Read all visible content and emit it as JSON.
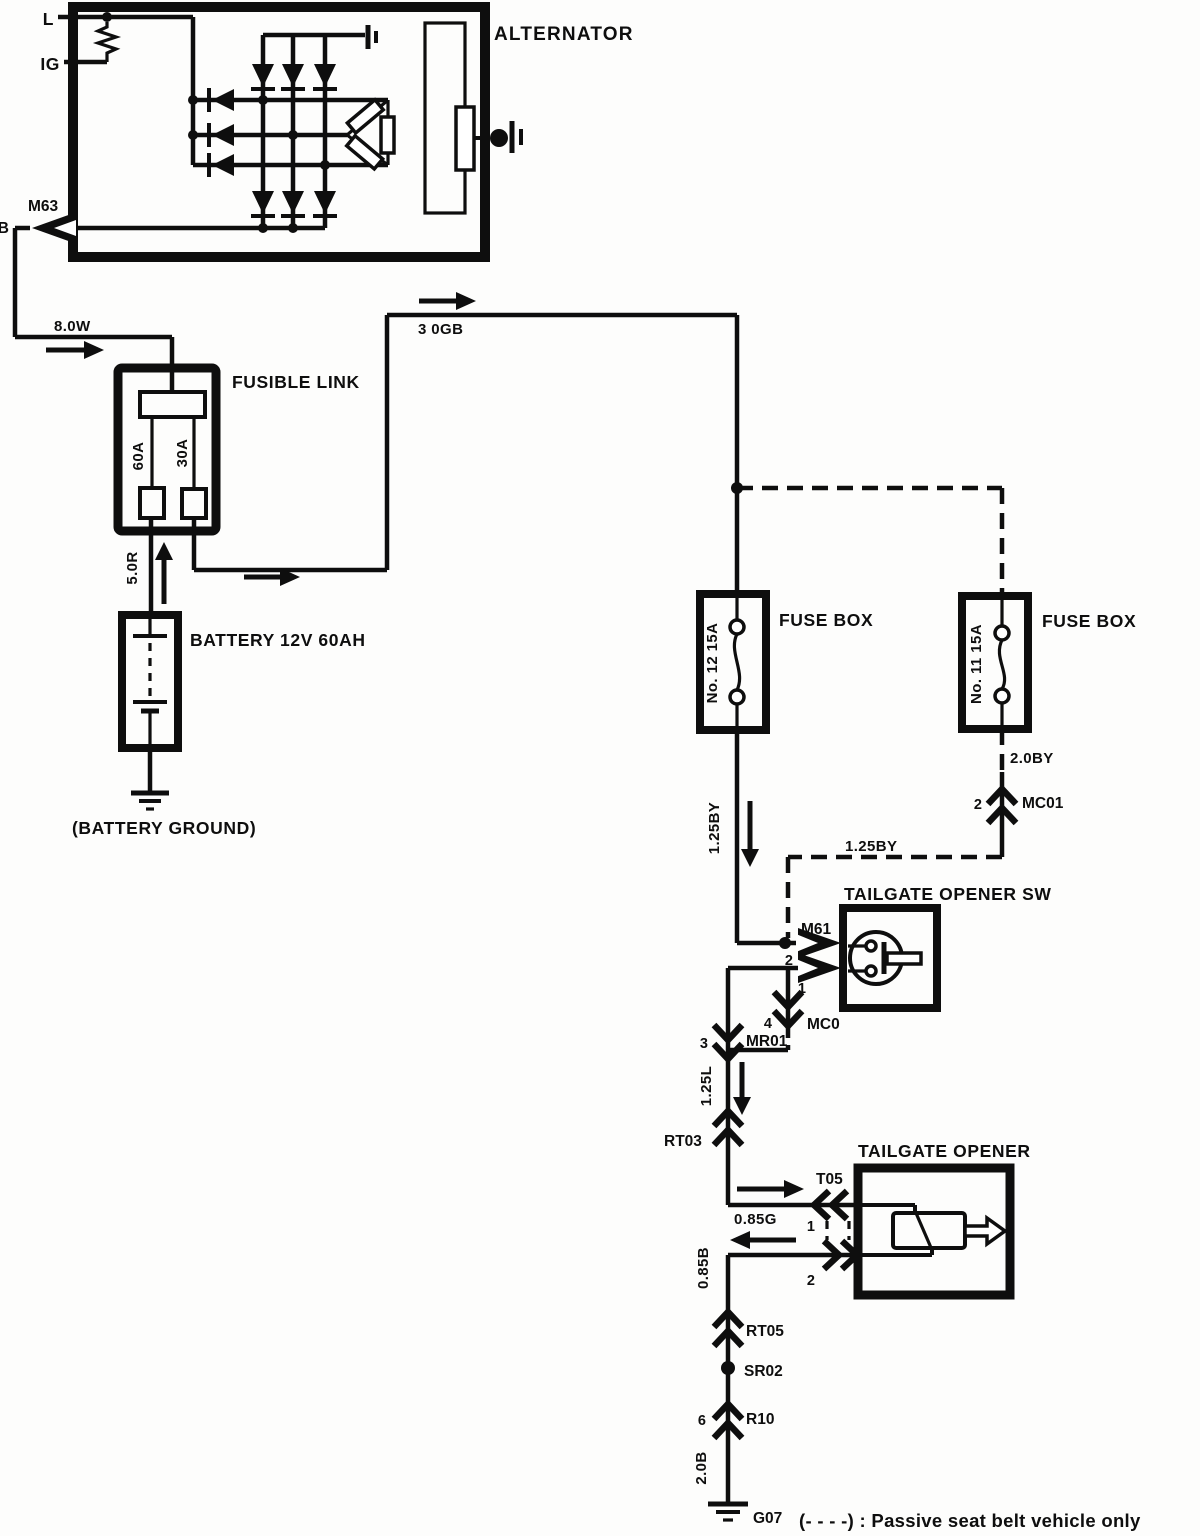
{
  "alternator": {
    "label": "ALTERNATOR",
    "terminal_l": "L",
    "terminal_ig": "IG",
    "terminal_b": "B",
    "connector_m63": "M63"
  },
  "wires": {
    "w8_0w": "8.0W",
    "w3_0gb": "3 0GB",
    "w5_0r": "5.0R",
    "w1_25by_vertical": "1.25BY",
    "w1_25by_horizontal": "1.25BY",
    "w2_0by": "2.0BY",
    "w1_25l": "1.25L",
    "w0_85g": "0.85G",
    "w0_85b": "0.85B",
    "w2_0b": "2.0B"
  },
  "fusible_link": {
    "label": "FUSIBLE LINK",
    "fuse_left": "60A",
    "fuse_right": "30A"
  },
  "battery": {
    "label": "BATTERY 12V 60AH",
    "ground_label": "(BATTERY GROUND)"
  },
  "fuse_box_no12": {
    "label": "FUSE BOX",
    "fuse": "No. 12  15A"
  },
  "fuse_box_no11": {
    "label": "FUSE BOX",
    "fuse": "No. 11  15A"
  },
  "tailgate_opener_sw": {
    "label": "TAILGATE OPENER SW",
    "connector": "M61",
    "pin_top": "2",
    "pin_bottom": "1"
  },
  "tailgate_opener": {
    "label": "TAILGATE OPENER",
    "connector": "T05",
    "pin_top": "1",
    "pin_bottom": "2"
  },
  "connectors": {
    "mc01": {
      "name": "MC01",
      "pin": "2"
    },
    "mc0": {
      "name": "MC0",
      "pin": "4"
    },
    "mr01": {
      "name": "MR01",
      "pin": "3"
    },
    "rt03": {
      "name": "RT03"
    },
    "rt05": {
      "name": "RT05"
    },
    "sr02": {
      "name": "SR02"
    },
    "r10": {
      "name": "R10",
      "pin": "6"
    },
    "g07": {
      "name": "G07"
    }
  },
  "note": "(- - - -) : Passive seat belt vehicle only"
}
